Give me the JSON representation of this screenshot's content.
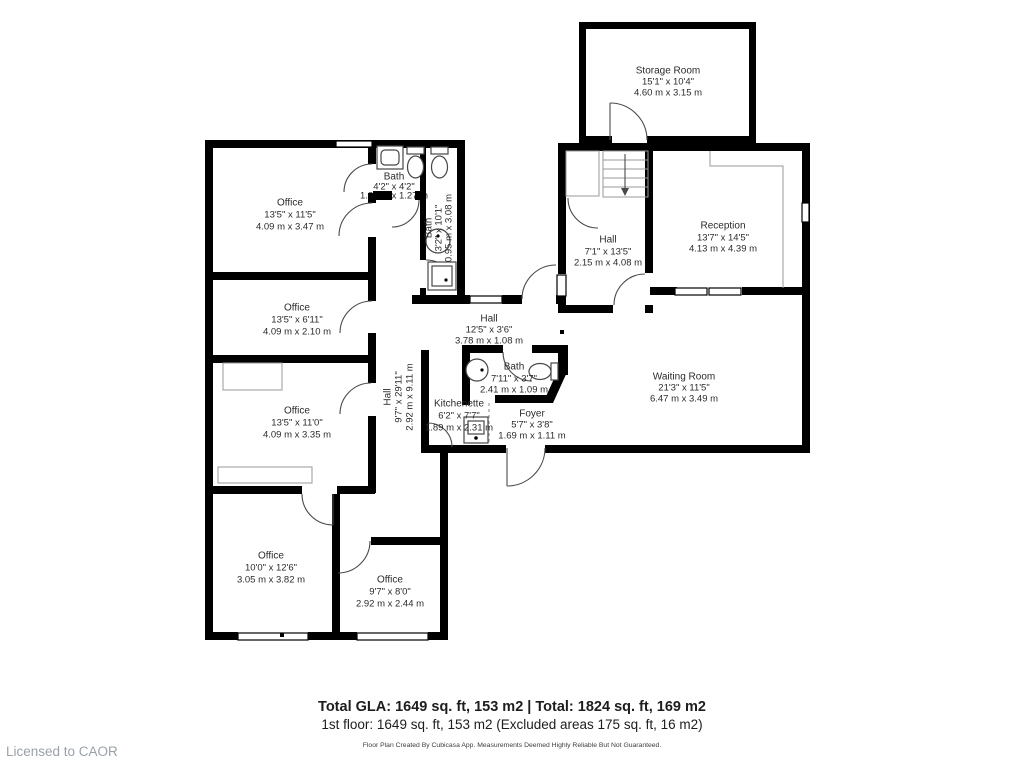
{
  "page": {
    "license_text": "Licensed to CAOR",
    "footer": {
      "total_line": "Total GLA: 1649 sq. ft, 153 m2 | Total: 1824 sq. ft, 169 m2",
      "floor_line": "1st floor: 1649 sq. ft, 153 m2 (Excluded areas 175 sq. ft, 16 m2)",
      "disclaimer": "Floor Plan Created By Cubicasa App. Measurements Deemed Highly Reliable But Not Guaranteed."
    },
    "wall_color": "#000000",
    "background": "#ffffff"
  },
  "rooms": {
    "storage": {
      "name": "Storage Room",
      "imperial": "15'1\" x 10'4\"",
      "metric": "4.60 m x 3.15 m"
    },
    "office1": {
      "name": "Office",
      "imperial": "13'5\" x 11'5\"",
      "metric": "4.09 m x 3.47 m"
    },
    "office2": {
      "name": "Office",
      "imperial": "13'5\" x 6'11\"",
      "metric": "4.09 m x 2.10 m"
    },
    "office3": {
      "name": "Office",
      "imperial": "13'5\" x 11'0\"",
      "metric": "4.09 m x 3.35 m"
    },
    "office4": {
      "name": "Office",
      "imperial": "10'0\" x 12'6\"",
      "metric": "3.05 m x 3.82 m"
    },
    "office5": {
      "name": "Office",
      "imperial": "9'7\" x 8'0\"",
      "metric": "2.92 m x 2.44 m"
    },
    "hall_vertical": {
      "name": "Hall",
      "imperial": "9'7\" x 29'11\"",
      "metric": "2.92 m x 9.11 m"
    },
    "hall_middle": {
      "name": "Hall",
      "imperial": "12'5\" x 3'6\"",
      "metric": "3.78 m x 1.08 m"
    },
    "hall_upper": {
      "name": "Hall",
      "imperial": "7'1\" x 13'5\"",
      "metric": "2.15 m x 4.08 m"
    },
    "bath_top": {
      "name": "Bath",
      "imperial": "4'2\" x 4'2\"",
      "metric": "1.27 m x 1.27 m"
    },
    "bath_narrow": {
      "name": "Bath",
      "imperial": "3'2\" x 10'1\"",
      "metric": "0.95 m x 3.08 m"
    },
    "bath_middle": {
      "name": "Bath",
      "imperial": "7'11\" x 3'7\"",
      "metric": "2.41 m x 1.09 m"
    },
    "kitchenette": {
      "name": "Kitchenette",
      "imperial": "6'2\" x 7'7\"",
      "metric": "1.89 m x 2.31 m"
    },
    "foyer": {
      "name": "Foyer",
      "imperial": "5'7\" x 3'8\"",
      "metric": "1.69 m x 1.11 m"
    },
    "reception": {
      "name": "Reception",
      "imperial": "13'7\" x 14'5\"",
      "metric": "4.13 m x 4.39 m"
    },
    "waiting": {
      "name": "Waiting Room",
      "imperial": "21'3\" x 11'5\"",
      "metric": "6.47 m x 3.49 m"
    }
  }
}
